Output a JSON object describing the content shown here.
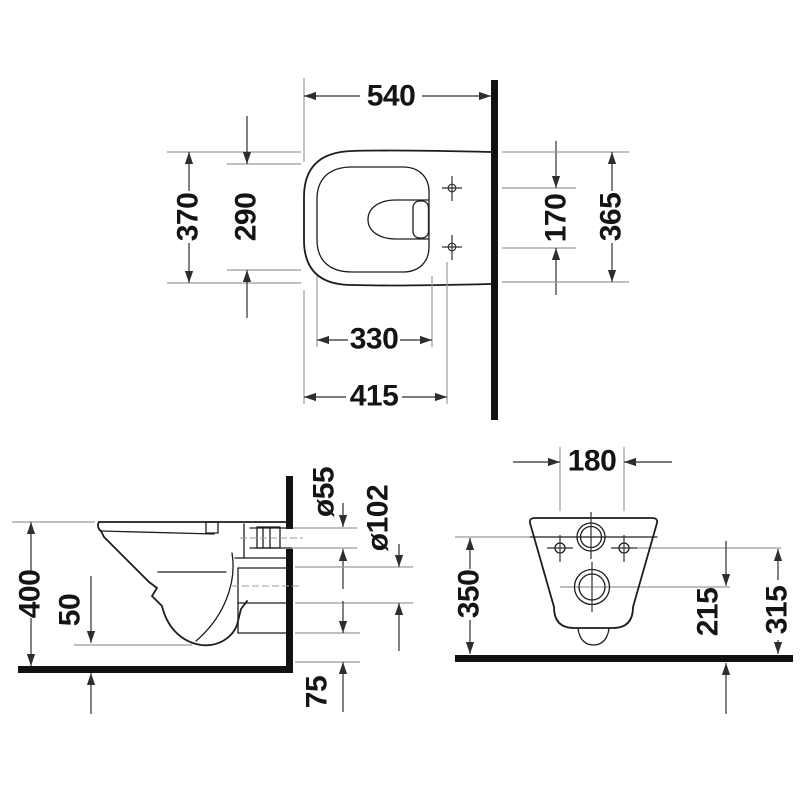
{
  "drawing": {
    "type": "technical-dimension-drawing",
    "subject": "wall-hung-toilet",
    "units": "mm",
    "views": [
      "top-view",
      "side-view",
      "rear-view"
    ]
  },
  "top_view": {
    "overall_depth": "540",
    "outer_width": "370",
    "bowl_inner_width": "290",
    "fixing_hole_spacing": "170",
    "rear_width": "365",
    "bowl_inner_length": "330",
    "seat_length": "415"
  },
  "side_view": {
    "height": "400",
    "bowl_base_offset": "50",
    "flush_connector_diameter": "ø55",
    "outlet_diameter": "ø102",
    "bottom_clearance": "75"
  },
  "rear_view": {
    "fixing_hole_spacing": "180",
    "body_height": "350",
    "outlet_center_height": "215",
    "fixing_hole_height": "315"
  },
  "colors": {
    "outline": "#1d1d1d",
    "dimension_line": "#2e2e2e",
    "extension_line": "#9b9b9b",
    "background": "#ffffff"
  }
}
